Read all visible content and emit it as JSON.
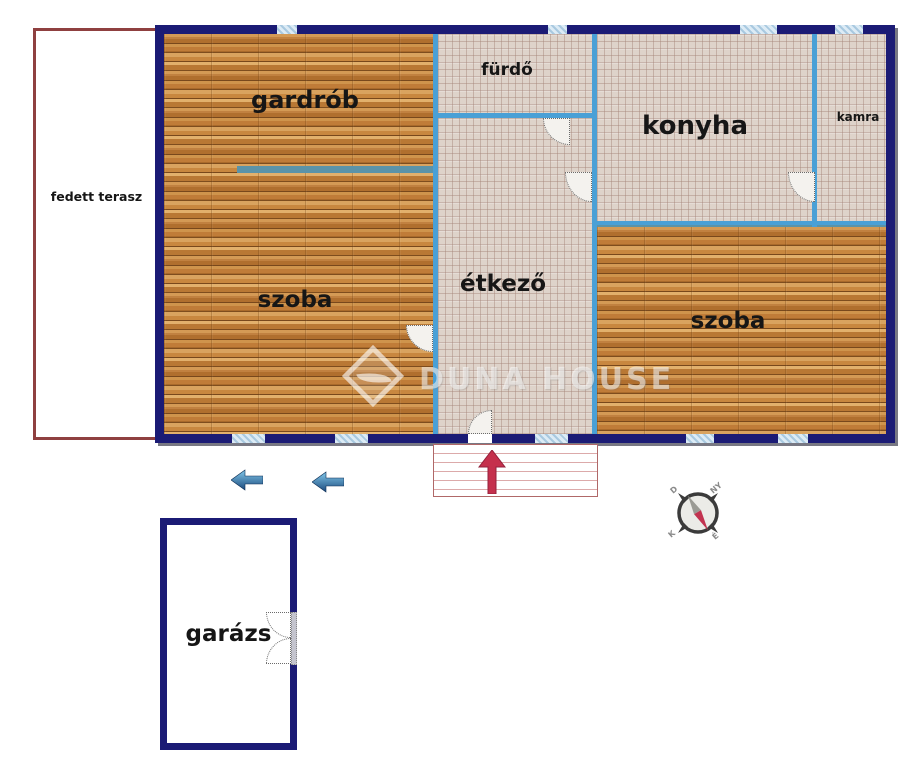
{
  "rooms": {
    "gardrob": "gardrób",
    "furdo": "fürdő",
    "konyha": "konyha",
    "kamra": "kamra",
    "szoba_left": "szoba",
    "etkezo": "étkező",
    "szoba_right": "szoba",
    "terasz": "fedett terasz",
    "garazs": "garázs"
  },
  "compass": {
    "d": "D",
    "ny": "NY",
    "k": "K",
    "e": "É"
  },
  "watermark": {
    "text": "DUNA HOUSE"
  },
  "colors": {
    "outer_wall": "#1b1b75",
    "inner_wall": "#4aa0d6",
    "partition": "#5b93a8",
    "terrace_border": "#8f4040",
    "steps_border": "#b06868",
    "entry_arrow": "#c5304c",
    "direction_arrow": "#2a6fae"
  }
}
